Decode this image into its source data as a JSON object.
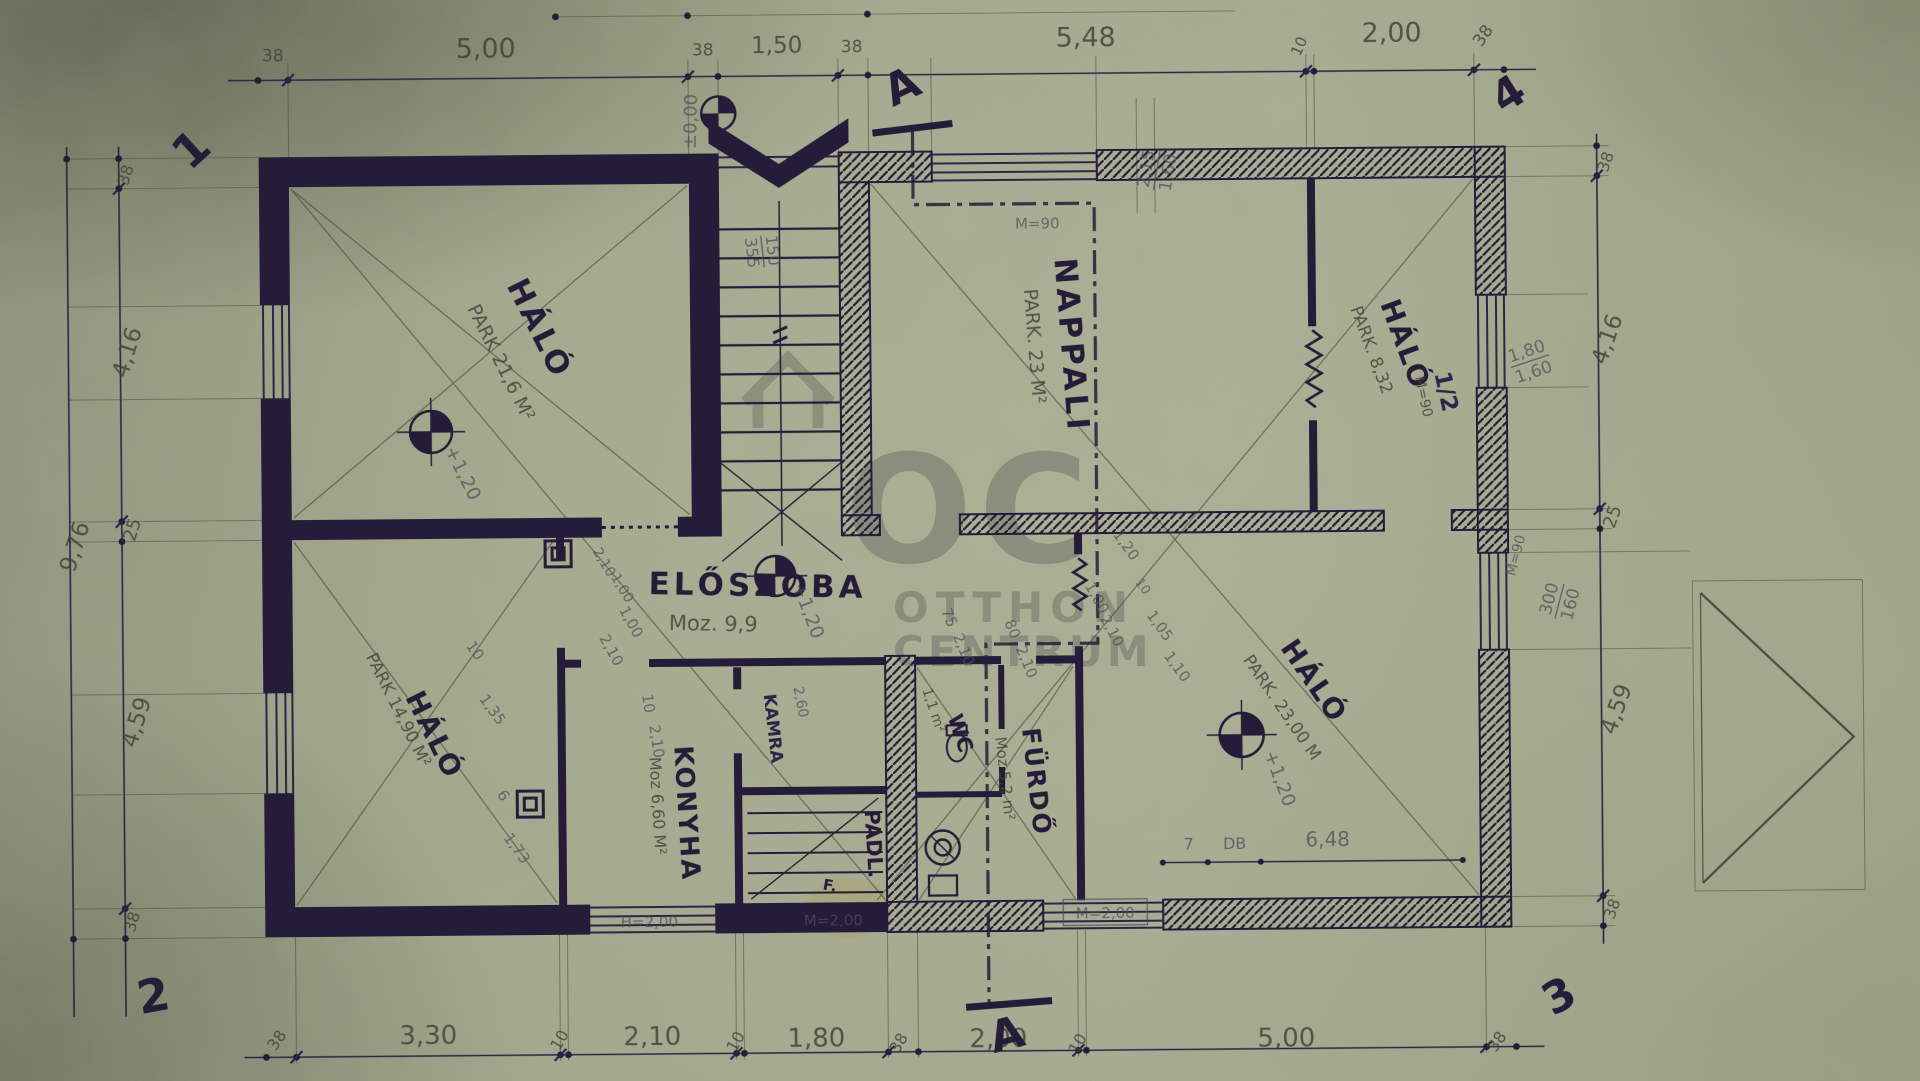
{
  "wm": {
    "logo": "OC",
    "l1": "OTTHON",
    "l2": "CENTRUM"
  },
  "ax": {
    "n1": "1",
    "n2": "2",
    "n3": "3",
    "n4": "4"
  },
  "sec": {
    "t": "A",
    "b": "A"
  },
  "top": [
    "38",
    "5,00",
    "38",
    "1,50",
    "38",
    "5,48",
    "10",
    "2,00",
    "38"
  ],
  "bot": [
    "38",
    "3,30",
    "10",
    "2,10",
    "10",
    "1,80",
    "38",
    "2,00",
    "10",
    "5,00",
    "38"
  ],
  "left": [
    "38",
    "4,16",
    "25",
    "4,59",
    "38"
  ],
  "louter": "9,76",
  "right": [
    "38",
    "4,16",
    "25",
    "4,59",
    "38"
  ],
  "rooms": {
    "tl": {
      "n": "HÁLÓ",
      "a": "PARK 21,6 M²"
    },
    "na": {
      "n": "NAPPALI",
      "a": "PARK. 23 M²"
    },
    "tr": {
      "n": "HÁLÓ",
      "a": "PARK. 8,32",
      "x": "1/2",
      "x2": "M=90"
    },
    "br": {
      "n": "HÁLÓ",
      "a": "PARK. 23,00 M"
    },
    "bl": {
      "n": "HÁLÓ",
      "a": "PARK 14,90 M²"
    },
    "el": {
      "n": "ELŐSZOBA",
      "a": "Moz. 9,9"
    },
    "ko": {
      "n": "KONYHA",
      "a": "Moz 6,60 M²"
    },
    "ka": {
      "n": "KAMRA"
    },
    "pa": {
      "n": "PADL.",
      "x": "F."
    },
    "wc": {
      "n": "WC",
      "a": "1,1 m²"
    },
    "fu": {
      "n": "FÜRDŐ",
      "a": "Moz 5,2 m²"
    }
  },
  "lv": {
    "e": "±0,00",
    "tl": "+1,20",
    "ha": "+1,20",
    "br": "+1,20"
  },
  "st": {
    "a": "150",
    "b": "355"
  },
  "win": {
    "nt_a": "2,15",
    "nt_b": "1,60",
    "nt_m": "M=90",
    "tr_a": "1,80",
    "tr_b": "1,60",
    "rl_a": "300",
    "rl_b": "160",
    "rl_m": "M=90"
  },
  "mk": {
    "h200": "H=2,00",
    "m200a": "M=2,00",
    "m200b": "M=2,00",
    "c7": "7",
    "db": "DB",
    "c648": "6,48"
  },
  "d": {
    "d1": "2,10",
    "d2": "1,00",
    "d3": "10",
    "d4": "2,10",
    "d5": "75",
    "d6": "2,10",
    "d7": "80",
    "d8": "2,10",
    "d9": "1,00",
    "d10": "2,10",
    "d11": "1,20",
    "d12": "10",
    "d13": "1,05",
    "d14": "1,10",
    "d15": "10",
    "d16": "1,35",
    "d17": "6",
    "d18": "1,73",
    "d19": "2,60",
    "d20": "2,10",
    "d21": "1,00"
  }
}
